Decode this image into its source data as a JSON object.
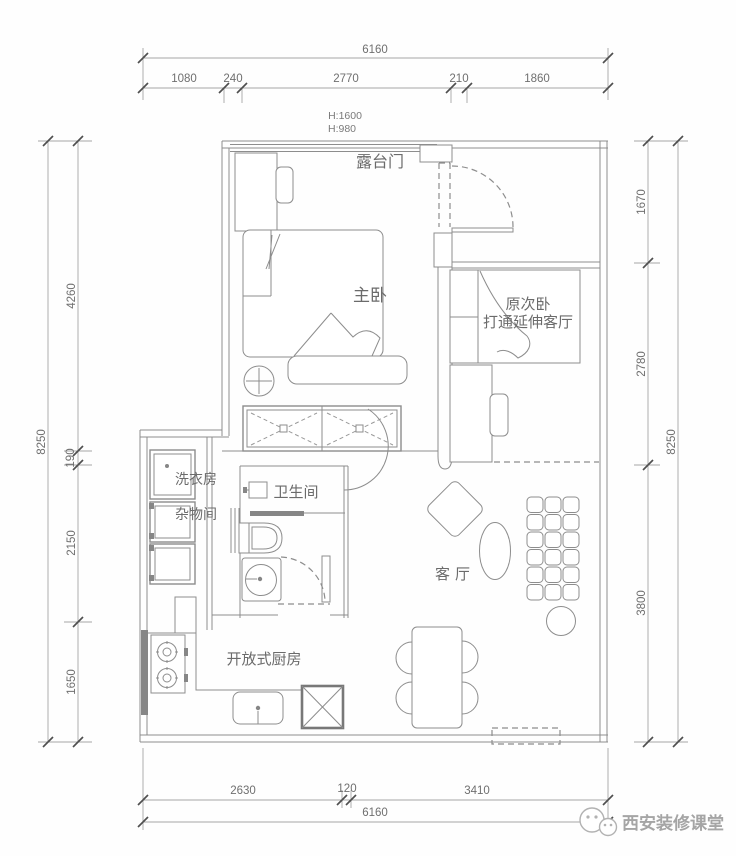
{
  "drawing": {
    "type": "apartment-floor-plan",
    "colors": {
      "wall_line": "#8d8d8d",
      "dim_line": "#a6a6a6",
      "dim_text": "#6f6f6f",
      "room_text": "#6b6b6b",
      "watermark": "#a5a5a5",
      "background": "#ffffff"
    },
    "dimensions": {
      "top": {
        "total": "6160",
        "segments": [
          "1080",
          "240",
          "2770",
          "210",
          "1860"
        ]
      },
      "bottom": {
        "total": "6160",
        "segments": [
          "2630",
          "120",
          "3410"
        ]
      },
      "left": {
        "total": "8250",
        "segments": [
          "4260",
          "190",
          "2150",
          "1650"
        ]
      },
      "right": {
        "total": "8250",
        "segments": [
          "1670",
          "2780",
          "3800"
        ]
      }
    },
    "height_notes": {
      "line1": "H:1600",
      "line2": "H:980"
    },
    "rooms": {
      "terrace_door": "露台门",
      "master_bedroom": "主卧",
      "second_bedroom_line1": "原次卧",
      "second_bedroom_line2": "打通延伸客厅",
      "laundry": "洗衣房",
      "storage": "杂物间",
      "bathroom": "卫生间",
      "living_room": "客厅",
      "kitchen": "开放式厨房"
    },
    "watermark": {
      "text": "西安装修课堂"
    }
  }
}
